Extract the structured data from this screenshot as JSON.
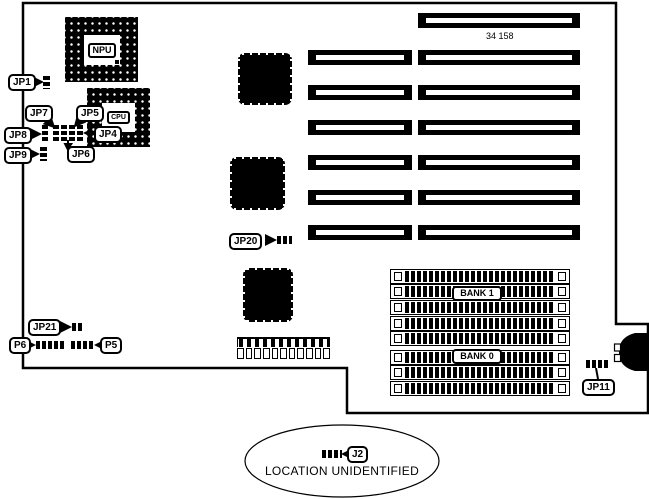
{
  "board": {
    "part_number": "34 158",
    "npu_label": "NPU",
    "cpu_label": "CPU",
    "labels": {
      "jp1": "JP1",
      "jp4": "JP4",
      "jp5": "JP5",
      "jp6": "JP6",
      "jp7": "JP7",
      "jp8": "JP8",
      "jp9": "JP9",
      "jp11": "JP11",
      "jp20": "JP20",
      "jp21": "JP21",
      "p5": "P5",
      "p6": "P6",
      "j2": "J2"
    },
    "memory": {
      "bank1_label": "BANK 1",
      "bank0_label": "BANK 0",
      "socket_count": 8
    },
    "expansion_slots": {
      "long_count": 7,
      "short_count": 6
    },
    "footer_note": "LOCATION UNIDENTIFIED"
  }
}
